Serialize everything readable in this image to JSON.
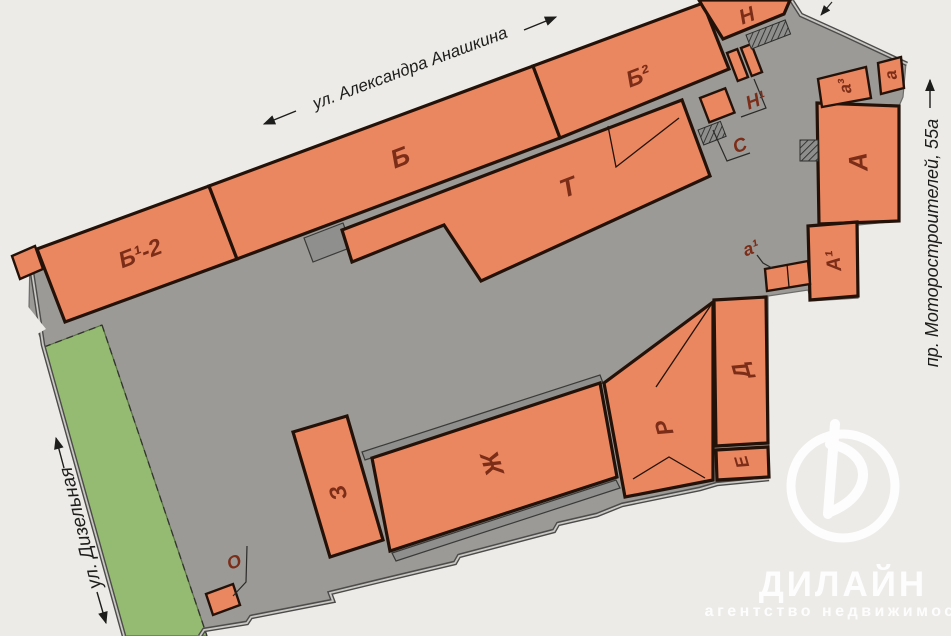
{
  "plan": {
    "streets": {
      "top": "ул. Александра Анашкина",
      "right": "пр. Моторостроителей, 55а",
      "left": "ул. Дизельная"
    },
    "buildings": {
      "b1_2": "Б¹-2",
      "b": "Б",
      "b2": "Б²",
      "n": "Н",
      "n1": "Н¹",
      "s": "С",
      "t": "Т",
      "A": "А",
      "A1": "А¹",
      "a3": "а³",
      "a": "а",
      "a1": "а¹",
      "d": "Д",
      "e": "Е",
      "r": "Р",
      "zh": "Ж",
      "z": "З",
      "o": "О"
    },
    "colors": {
      "building": "#ea8760",
      "outline": "#241209",
      "site": "#9c9a97",
      "site_dark": "#7b7977",
      "dock": "#8f8f8d",
      "green": "#95ba72",
      "background": "#edebe8",
      "label": "#7c2d18",
      "street_text": "#1d1d1b",
      "fence": "#4c4b49",
      "logo": "#ffffff"
    }
  },
  "logo": {
    "name": "ДИЛАЙН",
    "tagline": "агентство недвижимости"
  }
}
